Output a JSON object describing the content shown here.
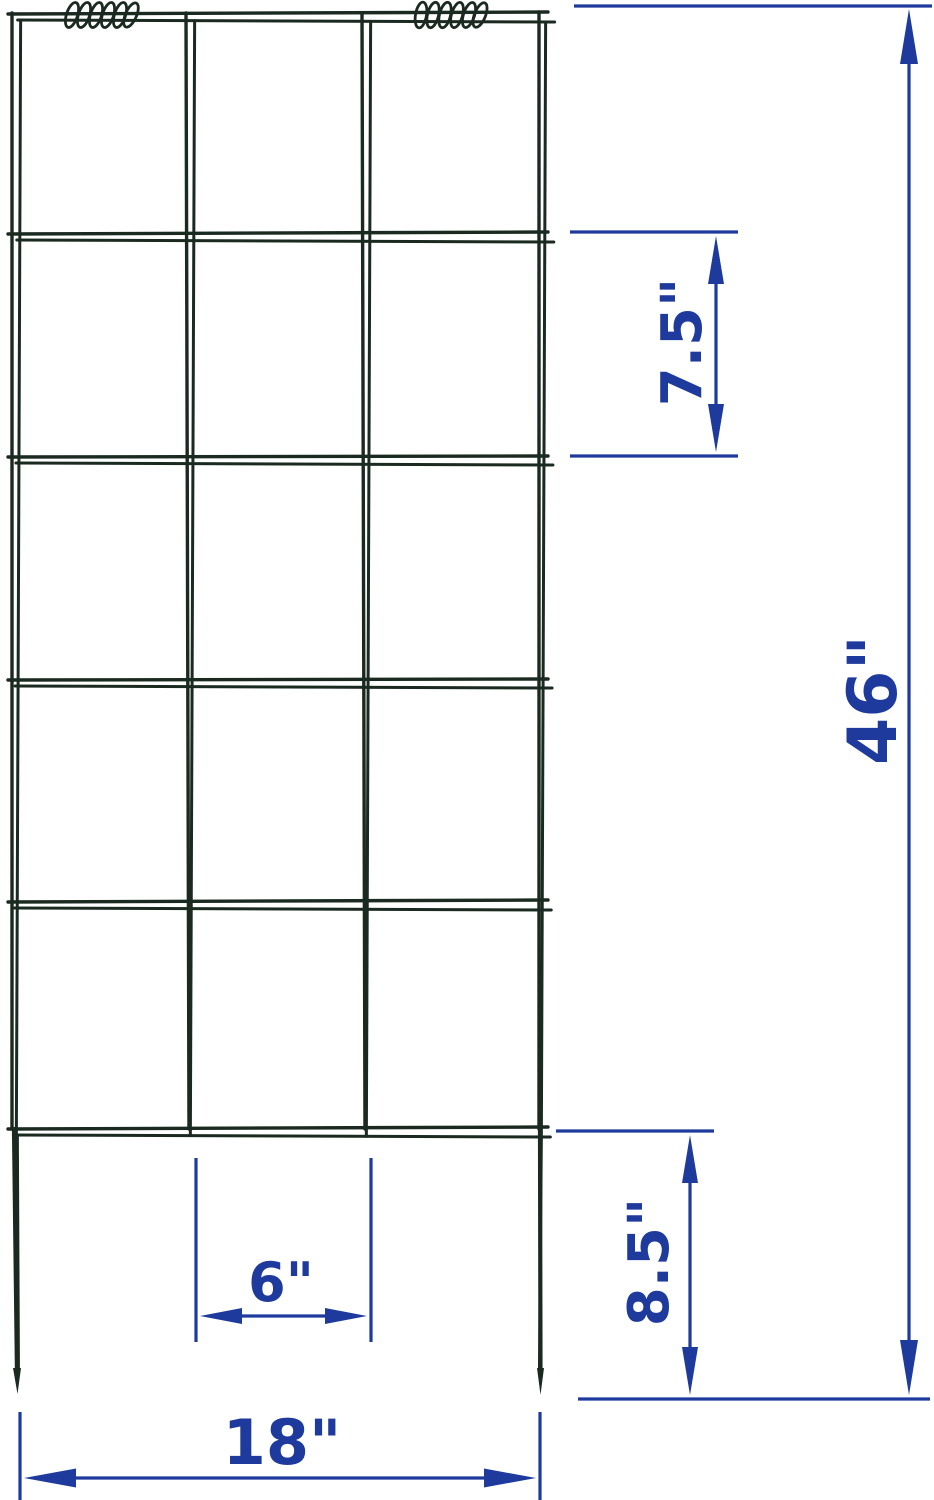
{
  "title": "trellis-dimension-diagram",
  "trellis": {
    "columns": 3,
    "rows": 5,
    "spring_clips": 2,
    "legs": 2
  },
  "dimensions": {
    "cell_height": {
      "label": "7.5\""
    },
    "total_height": {
      "label": "46\""
    },
    "cell_width": {
      "label": "6\""
    },
    "leg_height": {
      "label": "8.5\""
    },
    "total_width": {
      "label": "18\""
    }
  },
  "colors": {
    "wire": "#1b2a20",
    "dimension_blue": "#1e3a9c",
    "background": "#ffffff"
  }
}
